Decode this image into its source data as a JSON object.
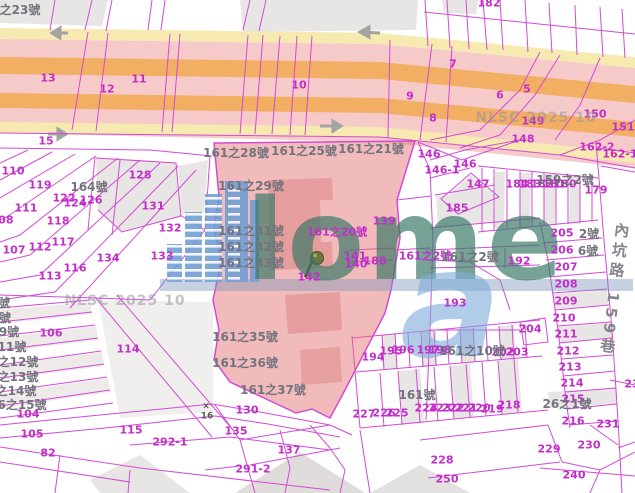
{
  "map": {
    "watermark_text": "NLSC 2025 10",
    "road_label": "內坑路 159巷",
    "logo": {
      "word": "lome",
      "a": "a"
    },
    "colors": {
      "parcel_line": "#d24bd5",
      "highlight_parcel_fill": "#e87a7a",
      "road_pink": "#f7caca",
      "road_orange": "#f2ae62",
      "road_yellow": "#f7eab0",
      "label_magenta": "#c32ec9",
      "label_gray": "#73737d",
      "logo_teal": "#377866",
      "logo_blue": "#6f9ed6"
    },
    "labels": [
      {
        "t": "13",
        "x": 48,
        "y": 78,
        "c": "m"
      },
      {
        "t": "12",
        "x": 107,
        "y": 89,
        "c": "m"
      },
      {
        "t": "11",
        "x": 139,
        "y": 79,
        "c": "m"
      },
      {
        "t": "15",
        "x": 46,
        "y": 141,
        "c": "m"
      },
      {
        "t": "10",
        "x": 299,
        "y": 85,
        "c": "m"
      },
      {
        "t": "9",
        "x": 410,
        "y": 96,
        "c": "m"
      },
      {
        "t": "7",
        "x": 453,
        "y": 64,
        "c": "m"
      },
      {
        "t": "5",
        "x": 527,
        "y": 89,
        "c": "m"
      },
      {
        "t": "6",
        "x": 500,
        "y": 95,
        "c": "m"
      },
      {
        "t": "8",
        "x": 433,
        "y": 118,
        "c": "m"
      },
      {
        "t": "182",
        "x": 489,
        "y": 3,
        "c": "m"
      },
      {
        "t": "150",
        "x": 595,
        "y": 114,
        "c": "m"
      },
      {
        "t": "149",
        "x": 533,
        "y": 121,
        "c": "m"
      },
      {
        "t": "151",
        "x": 623,
        "y": 127,
        "c": "m"
      },
      {
        "t": "148",
        "x": 523,
        "y": 139,
        "c": "m"
      },
      {
        "t": "162-2",
        "x": 597,
        "y": 147,
        "c": "m"
      },
      {
        "t": "162-1",
        "x": 620,
        "y": 154,
        "c": "m"
      },
      {
        "t": "146",
        "x": 429,
        "y": 154,
        "c": "m"
      },
      {
        "t": "146-1",
        "x": 442,
        "y": 170,
        "c": "m"
      },
      {
        "t": "146",
        "x": 465,
        "y": 164,
        "c": "m"
      },
      {
        "t": "147",
        "x": 478,
        "y": 184,
        "c": "m"
      },
      {
        "t": "184",
        "x": 517,
        "y": 184,
        "c": "m"
      },
      {
        "t": "183",
        "x": 530,
        "y": 184,
        "c": "m"
      },
      {
        "t": "182",
        "x": 542,
        "y": 184,
        "c": "m"
      },
      {
        "t": "181",
        "x": 554,
        "y": 184,
        "c": "m"
      },
      {
        "t": "180",
        "x": 565,
        "y": 184,
        "c": "m"
      },
      {
        "t": "179",
        "x": 596,
        "y": 190,
        "c": "m"
      },
      {
        "t": "185",
        "x": 457,
        "y": 208,
        "c": "m"
      },
      {
        "t": "128",
        "x": 140,
        "y": 175,
        "c": "m"
      },
      {
        "t": "110",
        "x": 13,
        "y": 171,
        "c": "m"
      },
      {
        "t": "119",
        "x": 40,
        "y": 185,
        "c": "m"
      },
      {
        "t": "122",
        "x": 64,
        "y": 198,
        "c": "m"
      },
      {
        "t": "124",
        "x": 75,
        "y": 203,
        "c": "m"
      },
      {
        "t": "126",
        "x": 91,
        "y": 200,
        "c": "m"
      },
      {
        "t": "111",
        "x": 26,
        "y": 208,
        "c": "m"
      },
      {
        "t": "131",
        "x": 153,
        "y": 206,
        "c": "m"
      },
      {
        "t": "108",
        "x": 2,
        "y": 220,
        "c": "m"
      },
      {
        "t": "118",
        "x": 58,
        "y": 221,
        "c": "m"
      },
      {
        "t": "132",
        "x": 170,
        "y": 228,
        "c": "m"
      },
      {
        "t": "107",
        "x": 14,
        "y": 250,
        "c": "m"
      },
      {
        "t": "112",
        "x": 40,
        "y": 247,
        "c": "m"
      },
      {
        "t": "117",
        "x": 63,
        "y": 242,
        "c": "m"
      },
      {
        "t": "134",
        "x": 108,
        "y": 258,
        "c": "m"
      },
      {
        "t": "133",
        "x": 162,
        "y": 256,
        "c": "m"
      },
      {
        "t": "113",
        "x": 50,
        "y": 276,
        "c": "m"
      },
      {
        "t": "116",
        "x": 75,
        "y": 268,
        "c": "m"
      },
      {
        "t": "139",
        "x": 384,
        "y": 221,
        "c": "m"
      },
      {
        "t": "141",
        "x": 355,
        "y": 256,
        "c": "m"
      },
      {
        "t": "140",
        "x": 356,
        "y": 264,
        "c": "m"
      },
      {
        "t": "188",
        "x": 375,
        "y": 261,
        "c": "m"
      },
      {
        "t": "142",
        "x": 309,
        "y": 277,
        "c": "m"
      },
      {
        "t": "161之20號",
        "x": 337,
        "y": 232,
        "c": "m"
      },
      {
        "t": "161之2號",
        "x": 425,
        "y": 256,
        "c": "m"
      },
      {
        "t": "192",
        "x": 519,
        "y": 261,
        "c": "m"
      },
      {
        "t": "193",
        "x": 455,
        "y": 303,
        "c": "m"
      },
      {
        "t": "106",
        "x": 51,
        "y": 333,
        "c": "m"
      },
      {
        "t": "114",
        "x": 128,
        "y": 349,
        "c": "m"
      },
      {
        "t": "104",
        "x": 28,
        "y": 414,
        "c": "m"
      },
      {
        "t": "105",
        "x": 32,
        "y": 434,
        "c": "m"
      },
      {
        "t": "115",
        "x": 131,
        "y": 430,
        "c": "m"
      },
      {
        "t": "82",
        "x": 48,
        "y": 453,
        "c": "m"
      },
      {
        "t": "292-1",
        "x": 170,
        "y": 442,
        "c": "m"
      },
      {
        "t": "130",
        "x": 247,
        "y": 410,
        "c": "m"
      },
      {
        "t": "135",
        "x": 236,
        "y": 431,
        "c": "m"
      },
      {
        "t": "137",
        "x": 289,
        "y": 450,
        "c": "m"
      },
      {
        "t": "291-2",
        "x": 253,
        "y": 469,
        "c": "m"
      },
      {
        "t": "194",
        "x": 373,
        "y": 357,
        "c": "m"
      },
      {
        "t": "195",
        "x": 391,
        "y": 351,
        "c": "m"
      },
      {
        "t": "196",
        "x": 403,
        "y": 350,
        "c": "m"
      },
      {
        "t": "197",
        "x": 428,
        "y": 350,
        "c": "m"
      },
      {
        "t": "198",
        "x": 440,
        "y": 350,
        "c": "m"
      },
      {
        "t": "202",
        "x": 503,
        "y": 352,
        "c": "m"
      },
      {
        "t": "203",
        "x": 517,
        "y": 352,
        "c": "m"
      },
      {
        "t": "204",
        "x": 530,
        "y": 329,
        "c": "m"
      },
      {
        "t": "227",
        "x": 364,
        "y": 414,
        "c": "m"
      },
      {
        "t": "226",
        "x": 384,
        "y": 413,
        "c": "m"
      },
      {
        "t": "225",
        "x": 397,
        "y": 413,
        "c": "m"
      },
      {
        "t": "224",
        "x": 426,
        "y": 408,
        "c": "m"
      },
      {
        "t": "223",
        "x": 440,
        "y": 408,
        "c": "m"
      },
      {
        "t": "222",
        "x": 453,
        "y": 408,
        "c": "m"
      },
      {
        "t": "221",
        "x": 466,
        "y": 408,
        "c": "m"
      },
      {
        "t": "220",
        "x": 479,
        "y": 408,
        "c": "m"
      },
      {
        "t": "219",
        "x": 492,
        "y": 409,
        "c": "m"
      },
      {
        "t": "218",
        "x": 509,
        "y": 405,
        "c": "m"
      },
      {
        "t": "205",
        "x": 562,
        "y": 233,
        "c": "m"
      },
      {
        "t": "206",
        "x": 562,
        "y": 250,
        "c": "m"
      },
      {
        "t": "207",
        "x": 566,
        "y": 267,
        "c": "m"
      },
      {
        "t": "208",
        "x": 566,
        "y": 284,
        "c": "m"
      },
      {
        "t": "209",
        "x": 566,
        "y": 301,
        "c": "m"
      },
      {
        "t": "210",
        "x": 564,
        "y": 318,
        "c": "m"
      },
      {
        "t": "211",
        "x": 566,
        "y": 334,
        "c": "m"
      },
      {
        "t": "212",
        "x": 568,
        "y": 351,
        "c": "m"
      },
      {
        "t": "213",
        "x": 570,
        "y": 367,
        "c": "m"
      },
      {
        "t": "214",
        "x": 572,
        "y": 383,
        "c": "m"
      },
      {
        "t": "215",
        "x": 573,
        "y": 399,
        "c": "m"
      },
      {
        "t": "216",
        "x": 573,
        "y": 421,
        "c": "m"
      },
      {
        "t": "231",
        "x": 608,
        "y": 424,
        "c": "m"
      },
      {
        "t": "23",
        "x": 632,
        "y": 384,
        "c": "m"
      },
      {
        "t": "229",
        "x": 549,
        "y": 449,
        "c": "m"
      },
      {
        "t": "230",
        "x": 589,
        "y": 445,
        "c": "m"
      },
      {
        "t": "228",
        "x": 442,
        "y": 460,
        "c": "m"
      },
      {
        "t": "250",
        "x": 447,
        "y": 479,
        "c": "m"
      },
      {
        "t": "240",
        "x": 574,
        "y": 475,
        "c": "m"
      },
      {
        "t": "之23號",
        "x": 20,
        "y": 10,
        "c": "g"
      },
      {
        "t": "164號",
        "x": 89,
        "y": 187,
        "c": "g"
      },
      {
        "t": "161之28號",
        "x": 236,
        "y": 153,
        "c": "g"
      },
      {
        "t": "161之25號",
        "x": 304,
        "y": 151,
        "c": "g"
      },
      {
        "t": "161之21號",
        "x": 371,
        "y": 149,
        "c": "g"
      },
      {
        "t": "161之29號",
        "x": 251,
        "y": 186,
        "c": "g"
      },
      {
        "t": "161之31號",
        "x": 251,
        "y": 231,
        "c": "g"
      },
      {
        "t": "161之32號",
        "x": 251,
        "y": 247,
        "c": "g"
      },
      {
        "t": "161之33號",
        "x": 251,
        "y": 263,
        "c": "g"
      },
      {
        "t": "161之35號",
        "x": 245,
        "y": 337,
        "c": "g"
      },
      {
        "t": "161之36號",
        "x": 245,
        "y": 363,
        "c": "g"
      },
      {
        "t": "161之37號",
        "x": 273,
        "y": 390,
        "c": "g"
      },
      {
        "t": "159之2號",
        "x": 565,
        "y": 180,
        "c": "g"
      },
      {
        "t": "2號",
        "x": 589,
        "y": 234,
        "c": "g"
      },
      {
        "t": "6號",
        "x": 588,
        "y": 251,
        "c": "g"
      },
      {
        "t": "161之2號",
        "x": 470,
        "y": 257,
        "c": "g"
      },
      {
        "t": "161之10號",
        "x": 472,
        "y": 351,
        "c": "g"
      },
      {
        "t": "161號",
        "x": 417,
        "y": 395,
        "c": "g"
      },
      {
        "t": "26之1號",
        "x": 567,
        "y": 404,
        "c": "g"
      },
      {
        "t": "號",
        "x": 4,
        "y": 303,
        "c": "g"
      },
      {
        "t": "號",
        "x": 5,
        "y": 318,
        "c": "g"
      },
      {
        "t": "9號",
        "x": 9,
        "y": 332,
        "c": "g"
      },
      {
        "t": "11號",
        "x": 12,
        "y": 347,
        "c": "g"
      },
      {
        "t": "之12號",
        "x": 18,
        "y": 362,
        "c": "g"
      },
      {
        "t": "之13號",
        "x": 18,
        "y": 377,
        "c": "g"
      },
      {
        "t": "之14號",
        "x": 16,
        "y": 391,
        "c": "g"
      },
      {
        "t": "6之15號",
        "x": 22,
        "y": 405,
        "c": "g"
      },
      {
        "t": "×",
        "x": 206,
        "y": 407,
        "c": "gs"
      },
      {
        "t": "16",
        "x": 207,
        "y": 417,
        "c": "gs"
      },
      {
        "t": "NLSC 2025 10",
        "x": 125,
        "y": 301,
        "c": "wm"
      },
      {
        "t": "NLSC 2025 10",
        "x": 536,
        "y": 118,
        "c": "wm"
      }
    ]
  }
}
